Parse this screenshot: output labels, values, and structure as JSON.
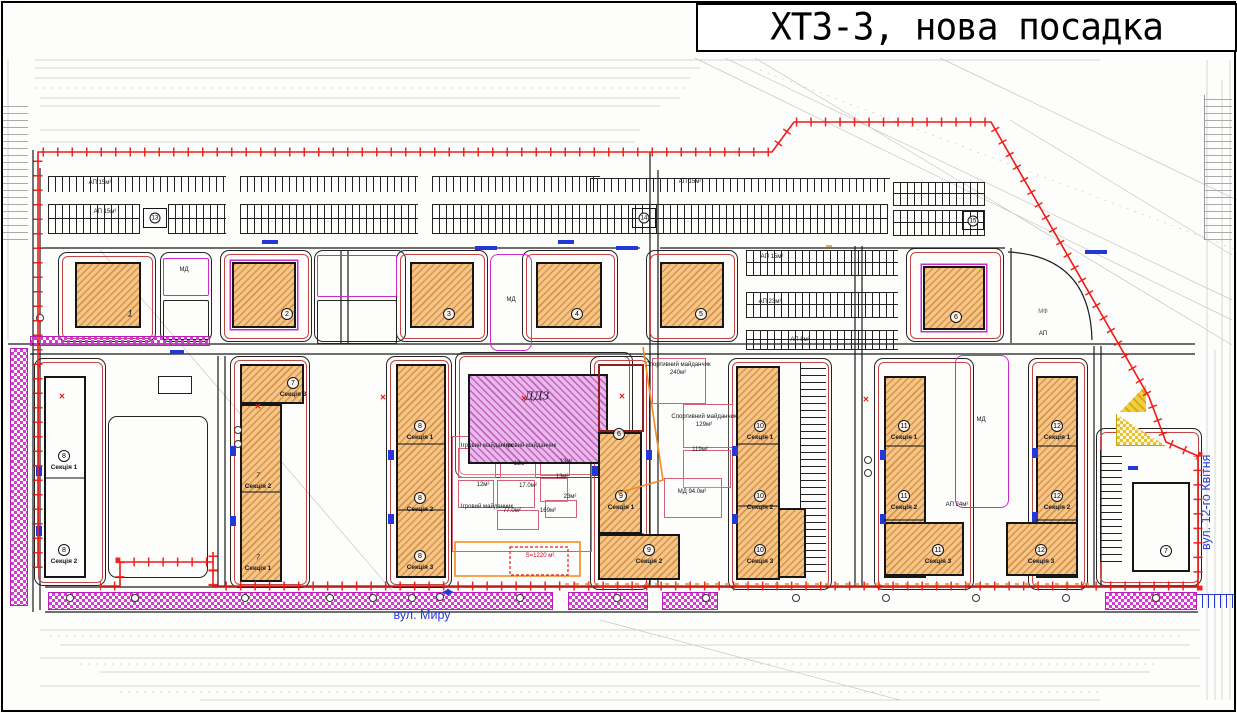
{
  "title": "ХТЗ-3, нова посадка",
  "streets": {
    "bottom": "вул. Миру",
    "right": "вул. 12-го Квітня"
  },
  "colors": {
    "boundary_red": "#ef1a17",
    "curb_black": "#1b1b1b",
    "building_fill": "#f5c488",
    "hatch_line": "#c6761a",
    "kindergarten_fill": "#e9b9ea",
    "magenta": "#cc2bcc",
    "blue": "#2438d8",
    "orange": "#f08a1e",
    "yellow": "#f3cf3a",
    "survey_grey": "#9b9b9b"
  },
  "map": {
    "plots": [
      [
        58,
        252,
        98,
        90,
        "red"
      ],
      [
        160,
        252,
        52,
        90,
        ""
      ],
      [
        220,
        250,
        92,
        92,
        "red"
      ],
      [
        314,
        250,
        92,
        92,
        ""
      ],
      [
        396,
        250,
        92,
        92,
        "red"
      ],
      [
        522,
        250,
        96,
        92,
        "red"
      ],
      [
        646,
        250,
        92,
        92,
        "red"
      ],
      [
        906,
        248,
        98,
        94,
        "red"
      ],
      [
        34,
        358,
        72,
        228,
        "red"
      ],
      [
        108,
        416,
        100,
        162,
        ""
      ],
      [
        230,
        356,
        80,
        232,
        "red"
      ],
      [
        386,
        356,
        66,
        232,
        "red"
      ],
      [
        455,
        352,
        178,
        126,
        "red"
      ],
      [
        590,
        356,
        60,
        234,
        "red"
      ],
      [
        728,
        358,
        104,
        232,
        "red"
      ],
      [
        874,
        358,
        100,
        232,
        "red"
      ],
      [
        1028,
        358,
        60,
        232,
        "red"
      ],
      [
        1096,
        428,
        106,
        158,
        "red"
      ],
      [
        490,
        254,
        42,
        97,
        "mag"
      ],
      [
        955,
        355,
        54,
        153,
        "mag"
      ],
      [
        163,
        258,
        46,
        38,
        "mag sq"
      ],
      [
        163,
        300,
        46,
        40,
        "sq"
      ],
      [
        317,
        255,
        80,
        42,
        "mag sq"
      ],
      [
        317,
        300,
        80,
        44,
        "sq"
      ]
    ],
    "rooms": [
      [
        452,
        436,
        140,
        116
      ],
      [
        458,
        448,
        38,
        30
      ],
      [
        500,
        448,
        36,
        30
      ],
      [
        540,
        450,
        30,
        26
      ],
      [
        458,
        480,
        36,
        28
      ],
      [
        497,
        480,
        38,
        28
      ],
      [
        540,
        478,
        28,
        24
      ],
      [
        497,
        510,
        42,
        20
      ],
      [
        545,
        500,
        32,
        18
      ],
      [
        652,
        358,
        54,
        46
      ],
      [
        683,
        404,
        50,
        44
      ],
      [
        683,
        450,
        48,
        38
      ],
      [
        664,
        478,
        58,
        40
      ]
    ],
    "buildings": [
      [
        468,
        374,
        140,
        90,
        "h-mag"
      ],
      [
        75,
        262,
        66,
        66,
        "h-diag"
      ],
      [
        232,
        262,
        64,
        66,
        "h-diag trim"
      ],
      [
        410,
        262,
        64,
        66,
        "h-diag"
      ],
      [
        536,
        262,
        66,
        66,
        "h-diag"
      ],
      [
        660,
        262,
        64,
        66,
        "h-diag"
      ],
      [
        923,
        266,
        62,
        64,
        "h-diag trim"
      ],
      [
        44,
        376,
        42,
        202,
        "h-brick"
      ],
      [
        240,
        364,
        64,
        40,
        "h-diag"
      ],
      [
        240,
        404,
        42,
        178,
        "h-diag"
      ],
      [
        396,
        364,
        50,
        214,
        "h-diag"
      ],
      [
        598,
        364,
        46,
        68,
        "h-pink"
      ],
      [
        598,
        432,
        44,
        102,
        "h-diag"
      ],
      [
        598,
        534,
        82,
        46,
        "h-diag"
      ],
      [
        736,
        366,
        44,
        214,
        "h-diag"
      ],
      [
        778,
        508,
        28,
        70,
        "h-diag"
      ],
      [
        884,
        376,
        42,
        202,
        "h-diag"
      ],
      [
        884,
        522,
        80,
        54,
        "h-diag"
      ],
      [
        1036,
        376,
        42,
        202,
        "h-diag"
      ],
      [
        1006,
        522,
        72,
        54,
        "h-diag"
      ],
      [
        1132,
        482,
        58,
        90,
        "h-brick"
      ],
      [
        143,
        208,
        24,
        20,
        "h-brick tp"
      ],
      [
        632,
        208,
        24,
        20,
        "h-brick tp"
      ],
      [
        962,
        211,
        22,
        19,
        "h-brick tp"
      ]
    ],
    "white_boxes": [
      [
        158,
        376,
        34,
        18
      ]
    ],
    "parkings": [
      [
        48,
        176,
        178,
        16,
        "h"
      ],
      [
        240,
        176,
        178,
        16,
        "h"
      ],
      [
        432,
        176,
        168,
        16,
        "h"
      ],
      [
        48,
        204,
        92,
        30,
        "h2"
      ],
      [
        168,
        204,
        58,
        30,
        "h2"
      ],
      [
        240,
        204,
        178,
        30,
        "h2"
      ],
      [
        432,
        204,
        168,
        30,
        "h2"
      ],
      [
        590,
        178,
        300,
        14,
        "h"
      ],
      [
        600,
        204,
        288,
        30,
        "h2"
      ],
      [
        893,
        182,
        92,
        24,
        "h2"
      ],
      [
        893,
        210,
        92,
        26,
        "h2"
      ],
      [
        746,
        250,
        152,
        26,
        "h2"
      ],
      [
        746,
        292,
        152,
        26,
        "h2"
      ],
      [
        746,
        330,
        152,
        20,
        "h2"
      ],
      [
        800,
        362,
        26,
        210,
        "v"
      ],
      [
        1100,
        450,
        22,
        112,
        "v"
      ],
      [
        2,
        100,
        26,
        140,
        "v grey"
      ],
      [
        1204,
        95,
        28,
        145,
        "v grey"
      ],
      [
        1196,
        594,
        38,
        14,
        "h blue"
      ]
    ],
    "strips": [
      [
        10,
        348,
        18,
        258
      ],
      [
        48,
        592,
        505,
        18
      ],
      [
        568,
        592,
        80,
        18
      ],
      [
        662,
        592,
        56,
        18
      ],
      [
        1105,
        592,
        92,
        18
      ],
      [
        30,
        336,
        180,
        10
      ]
    ],
    "triangles": [
      [
        1120,
        385,
        26,
        27,
        "y-solid"
      ],
      [
        1116,
        414,
        50,
        32,
        "y-check"
      ]
    ],
    "labels": [
      [
        "1",
        130,
        314,
        "num"
      ],
      [
        "2",
        287,
        314,
        "circ"
      ],
      [
        "3",
        449,
        314,
        "circ"
      ],
      [
        "4",
        577,
        314,
        "circ"
      ],
      [
        "5",
        701,
        314,
        "circ"
      ],
      [
        "6",
        956,
        317,
        "circ"
      ],
      [
        "13",
        155,
        218,
        "circ smc"
      ],
      [
        "14",
        644,
        218,
        "circ smc"
      ],
      [
        "15",
        973,
        221,
        "circ smc"
      ],
      [
        "8",
        64,
        456,
        "circ"
      ],
      [
        "Секція 1",
        64,
        468,
        "sec"
      ],
      [
        "8",
        64,
        550,
        "circ"
      ],
      [
        "Секція 2",
        64,
        562,
        "sec"
      ],
      [
        "7",
        293,
        383,
        "circ"
      ],
      [
        "Секція 3",
        293,
        395,
        "sec"
      ],
      [
        "7",
        258,
        476,
        "num sm"
      ],
      [
        "Секція 2",
        258,
        487,
        "sec"
      ],
      [
        "7",
        258,
        558,
        "num sm"
      ],
      [
        "Секція 1",
        258,
        569,
        "sec"
      ],
      [
        "8",
        420,
        426,
        "circ"
      ],
      [
        "Секція 1",
        420,
        438,
        "sec"
      ],
      [
        "8",
        420,
        498,
        "circ"
      ],
      [
        "Секція 2",
        420,
        510,
        "sec"
      ],
      [
        "8",
        420,
        556,
        "circ"
      ],
      [
        "Секція 3",
        420,
        568,
        "sec"
      ],
      [
        "6",
        619,
        434,
        "circ"
      ],
      [
        "9",
        621,
        496,
        "circ"
      ],
      [
        "Секція 1",
        621,
        508,
        "sec"
      ],
      [
        "9",
        649,
        550,
        "circ"
      ],
      [
        "Секція 2",
        649,
        562,
        "sec"
      ],
      [
        "10",
        760,
        426,
        "circ"
      ],
      [
        "Секція 1",
        760,
        438,
        "sec"
      ],
      [
        "10",
        760,
        496,
        "circ"
      ],
      [
        "Секція 2",
        760,
        508,
        "sec"
      ],
      [
        "10",
        760,
        550,
        "circ"
      ],
      [
        "Секція 3",
        760,
        562,
        "sec"
      ],
      [
        "11",
        904,
        426,
        "circ"
      ],
      [
        "Секція 1",
        904,
        438,
        "sec"
      ],
      [
        "11",
        904,
        496,
        "circ"
      ],
      [
        "Секція 2",
        904,
        508,
        "sec"
      ],
      [
        "11",
        938,
        550,
        "circ"
      ],
      [
        "Секція 3",
        938,
        562,
        "sec"
      ],
      [
        "12",
        1057,
        426,
        "circ"
      ],
      [
        "Секція 1",
        1057,
        438,
        "sec"
      ],
      [
        "12",
        1057,
        496,
        "circ"
      ],
      [
        "Секція 2",
        1057,
        508,
        "sec"
      ],
      [
        "12",
        1041,
        550,
        "circ"
      ],
      [
        "Секція 3",
        1041,
        562,
        "sec"
      ],
      [
        "7",
        1166,
        551,
        "circ"
      ],
      [
        "ДДЗ",
        537,
        396,
        "big"
      ],
      [
        "МД",
        184,
        270,
        "tiny"
      ],
      [
        "МД",
        511,
        300,
        "tiny"
      ],
      [
        "МД",
        981,
        420,
        "tiny"
      ],
      [
        "МД 94.0м²",
        692,
        492,
        "tiny"
      ],
      [
        "АП 24м²",
        957,
        505,
        "tiny"
      ],
      [
        "МФ",
        1043,
        312,
        "tiny grey"
      ],
      [
        "АП",
        1043,
        334,
        "tiny"
      ],
      [
        "Спортивний майданчик",
        678,
        365,
        "tiny"
      ],
      [
        "240м²",
        678,
        373,
        "tiny"
      ],
      [
        "Спортивний майданчик",
        704,
        417,
        "tiny"
      ],
      [
        "129м²",
        704,
        425,
        "tiny"
      ],
      [
        "119м²",
        700,
        450,
        "tiny"
      ],
      [
        "Ігровий майданчик",
        487,
        446,
        "tiny"
      ],
      [
        "Ігровий майданчик",
        530,
        446,
        "tiny"
      ],
      [
        "13м²",
        520,
        464,
        "tiny"
      ],
      [
        "13м²",
        566,
        462,
        "tiny"
      ],
      [
        "13м²",
        562,
        477,
        "tiny"
      ],
      [
        "12м²",
        483,
        485,
        "tiny"
      ],
      [
        "17.0м²",
        528,
        486,
        "tiny"
      ],
      [
        "77.0м²",
        512,
        511,
        "tiny"
      ],
      [
        "169м²",
        548,
        511,
        "tiny"
      ],
      [
        "23м²",
        570,
        497,
        "tiny"
      ],
      [
        "Ігровий майданчик",
        487,
        507,
        "tiny"
      ],
      [
        "S=1220 м²",
        540,
        556,
        "tiny red"
      ],
      [
        "АП 15м²",
        100,
        183,
        "tiny"
      ],
      [
        "АП 15м²",
        690,
        182,
        "tiny"
      ],
      [
        "АП 15м²",
        105,
        212,
        "tiny"
      ],
      [
        "АП 15м²",
        772,
        257,
        "tiny"
      ],
      [
        "АП 23м²",
        770,
        302,
        "tiny"
      ],
      [
        "АП 8м²",
        800,
        340,
        "tiny"
      ],
      [
        "◀▶",
        447,
        592,
        "bow blue"
      ]
    ],
    "circles": [
      [
        70,
        598
      ],
      [
        135,
        598
      ],
      [
        245,
        598
      ],
      [
        330,
        598
      ],
      [
        373,
        598
      ],
      [
        412,
        598
      ],
      [
        440,
        597
      ],
      [
        520,
        598
      ],
      [
        617,
        598
      ],
      [
        706,
        598
      ],
      [
        796,
        598
      ],
      [
        886,
        598
      ],
      [
        976,
        598
      ],
      [
        1066,
        598
      ],
      [
        1156,
        598
      ],
      [
        238,
        430
      ],
      [
        238,
        444
      ],
      [
        868,
        460
      ],
      [
        868,
        473
      ],
      [
        40,
        318
      ]
    ],
    "pads": [
      [
        36,
        466,
        6,
        10
      ],
      [
        36,
        526,
        6,
        10
      ],
      [
        230,
        446,
        6,
        10
      ],
      [
        230,
        516,
        6,
        10
      ],
      [
        388,
        450,
        6,
        10
      ],
      [
        388,
        514,
        6,
        10
      ],
      [
        592,
        466,
        6,
        10
      ],
      [
        646,
        450,
        6,
        10
      ],
      [
        732,
        446,
        6,
        10
      ],
      [
        732,
        514,
        6,
        10
      ],
      [
        880,
        450,
        6,
        10
      ],
      [
        880,
        514,
        6,
        10
      ],
      [
        1032,
        448,
        6,
        10
      ],
      [
        1032,
        512,
        6,
        10
      ],
      [
        262,
        240,
        16,
        4
      ],
      [
        558,
        240,
        16,
        4
      ],
      [
        475,
        246,
        22,
        4
      ],
      [
        616,
        246,
        22,
        4
      ],
      [
        1085,
        250,
        22,
        4
      ],
      [
        170,
        350,
        14,
        4
      ],
      [
        1128,
        466,
        10,
        4
      ]
    ],
    "crosses": [
      [
        62,
        397
      ],
      [
        258,
        407
      ],
      [
        383,
        398
      ],
      [
        524,
        399
      ],
      [
        622,
        397
      ],
      [
        866,
        400
      ]
    ],
    "svg": {
      "grey": "M35,60H1100M35,68H700M35,78H690M40,98H680M40,106H660M40,130H640M40,142H635M695,58L1232,320M725,58L1232,300M755,58L1232,345M940,58L1237,200M1010,120L1232,255M1207,60V700M1215,350V700M1222,80V700M1230,60V700M40,630H1200M60,645H1190M40,658H1200M100,672H1150M40,686H1200M200,700H1100M100,250L400,600M600,620L900,700M8,60V340",
      "grey_dash": "M50,636H1180M80,664H1160M120,692H1100M35,88H690M760,70L1237,250",
      "roads": "M33,150V612M40,168V610M38,248H640M660,248H1005M8,344H1195M30,354H1195M45,587H1198M45,612H1198M650,152V587M658,170V587M855,246V587M862,246V587M1094,346V587M1101,346V587M218,356V587M225,356V587M341,250V343M348,250V343M1011,248V343M1008,252Q1090,256 1092,340",
      "dividers": "M44,478H86M240,492H282M396,444H446M396,510H446M598,534H644M736,444H780M736,506H780M884,446H926M884,520H926M1036,446H1078M1036,520H1078",
      "boundary": "M38,568V152H772L794,122H991L1149,397L1166,442L1198,456V586H213V562H120V586H100M213,586V552",
      "orange": "M643,347L663,480L618,493M826,246h6",
      "orange_rect": "M455,542H580V576H455Z",
      "orange_dash": "M565,584H1092",
      "red_dash": "M510,547H568V575H510Z"
    }
  }
}
